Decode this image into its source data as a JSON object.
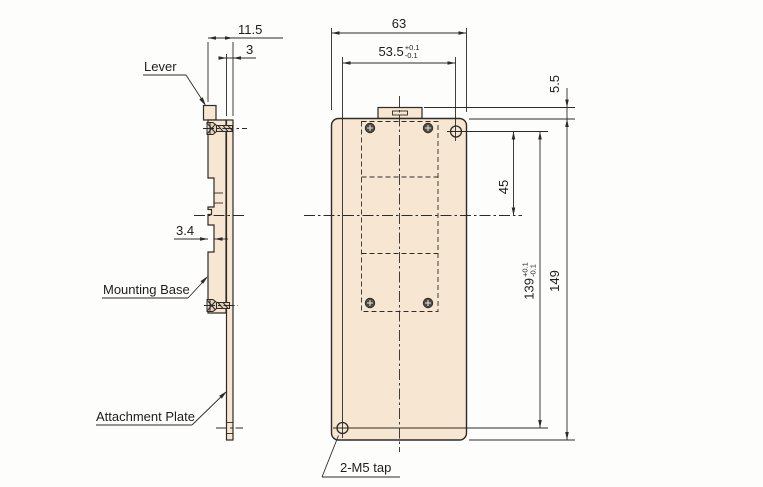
{
  "title": "Mounting base and attachment plate dimensional drawing",
  "side_view": {
    "labels": {
      "lever": "Lever",
      "mounting_base": "Mounting Base",
      "attachment_plate": "Attachment Plate"
    },
    "dims": {
      "overall_thickness": "11.5",
      "plate_thickness": "3",
      "notch_depth": "3.4"
    }
  },
  "front_view": {
    "labels": {
      "tap": "2-M5 tap"
    },
    "dims": {
      "overall_width": "63",
      "hole_pitch_x": {
        "value": "53.5",
        "tol_plus": "+0.1",
        "tol_minus": "-0.1"
      },
      "tab_height": "5.5",
      "hole_to_centerline": "45",
      "hole_pitch_y": {
        "value": "139",
        "tol_plus": "+0.1",
        "tol_minus": "-0.1"
      },
      "overall_height": "149"
    }
  },
  "colors": {
    "part_fill": "#f7e7d2",
    "line": "#2e2a26"
  }
}
